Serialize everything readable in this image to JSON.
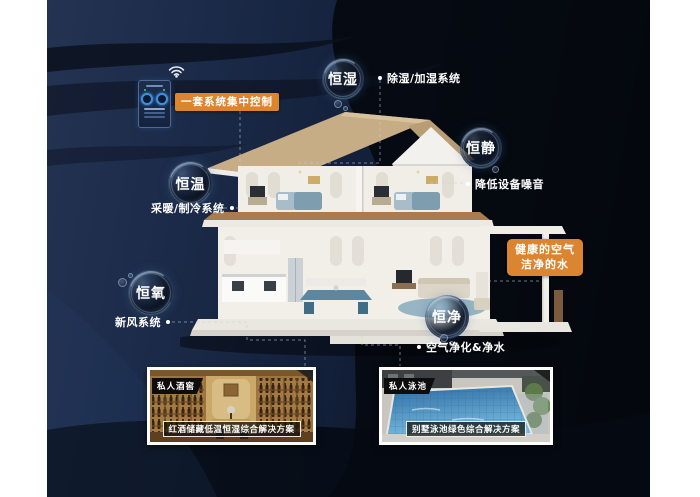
{
  "colors": {
    "accent_orange": "#DC8530",
    "canvas_navy": "#16233f",
    "text_white": "#ffffff",
    "pool_blue": "#3a7fb5",
    "wood_tan": "#b08a4e"
  },
  "icons": {
    "wifi_icon": "wifi-arcs",
    "note_bullet": "•",
    "control_knobs": "two-dial-knobs"
  },
  "control": {
    "label": "一套系统集中控制"
  },
  "bubbles": {
    "humidity": {
      "label": "恒湿",
      "note": "除湿/加湿系统"
    },
    "quiet": {
      "label": "恒静",
      "note": "降低设备噪音"
    },
    "temperature": {
      "label": "恒温",
      "note": "采暖/制冷系统"
    },
    "oxygen": {
      "label": "恒氧",
      "note": "新风系统"
    },
    "purity": {
      "label": "恒净",
      "note": "空气净化&净水"
    }
  },
  "highlight": {
    "line1": "健康的空气",
    "line2": "洁净的水"
  },
  "photos": [
    {
      "tag": "私人酒窖",
      "caption": "红酒储藏低温恒湿综合解决方案"
    },
    {
      "tag": "私人泳池",
      "caption": "别墅泳池绿色综合解决方案"
    }
  ]
}
